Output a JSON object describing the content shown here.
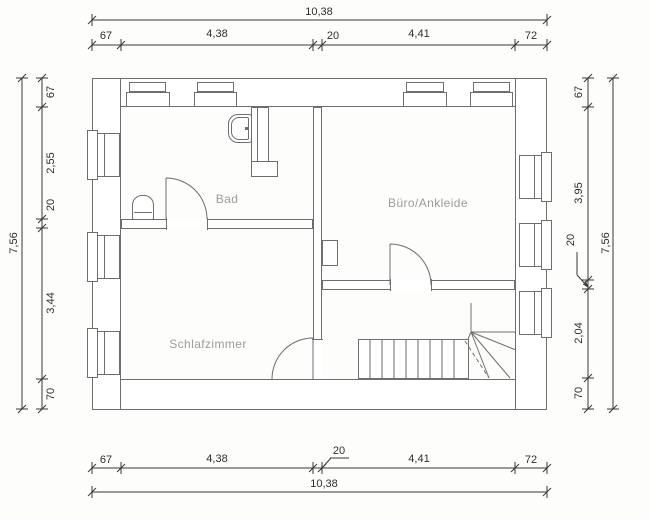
{
  "rooms": {
    "bad": "Bad",
    "buero": "Büro/Ankleide",
    "schlafzimmer": "Schlafzimmer"
  },
  "dimensions": {
    "top": {
      "overall": "10,38",
      "segments": [
        "67",
        "4,38",
        "20",
        "4,41",
        "72"
      ]
    },
    "bottom": {
      "overall": "10,38",
      "segments": [
        "67",
        "4,38",
        "20",
        "4,41",
        "72"
      ]
    },
    "left": {
      "overall": "7,56",
      "segments": [
        "67",
        "2,55",
        "20",
        "3,44",
        "70"
      ]
    },
    "right": {
      "overall": "7,56",
      "segments": [
        "67",
        "3,95",
        "20",
        "2,04",
        "70"
      ]
    }
  },
  "colors": {
    "background": "#fdfdfc",
    "plan_lines": "#6e6e6e",
    "dimension_lines": "#383838",
    "room_label_text": "#9c9c9c"
  }
}
